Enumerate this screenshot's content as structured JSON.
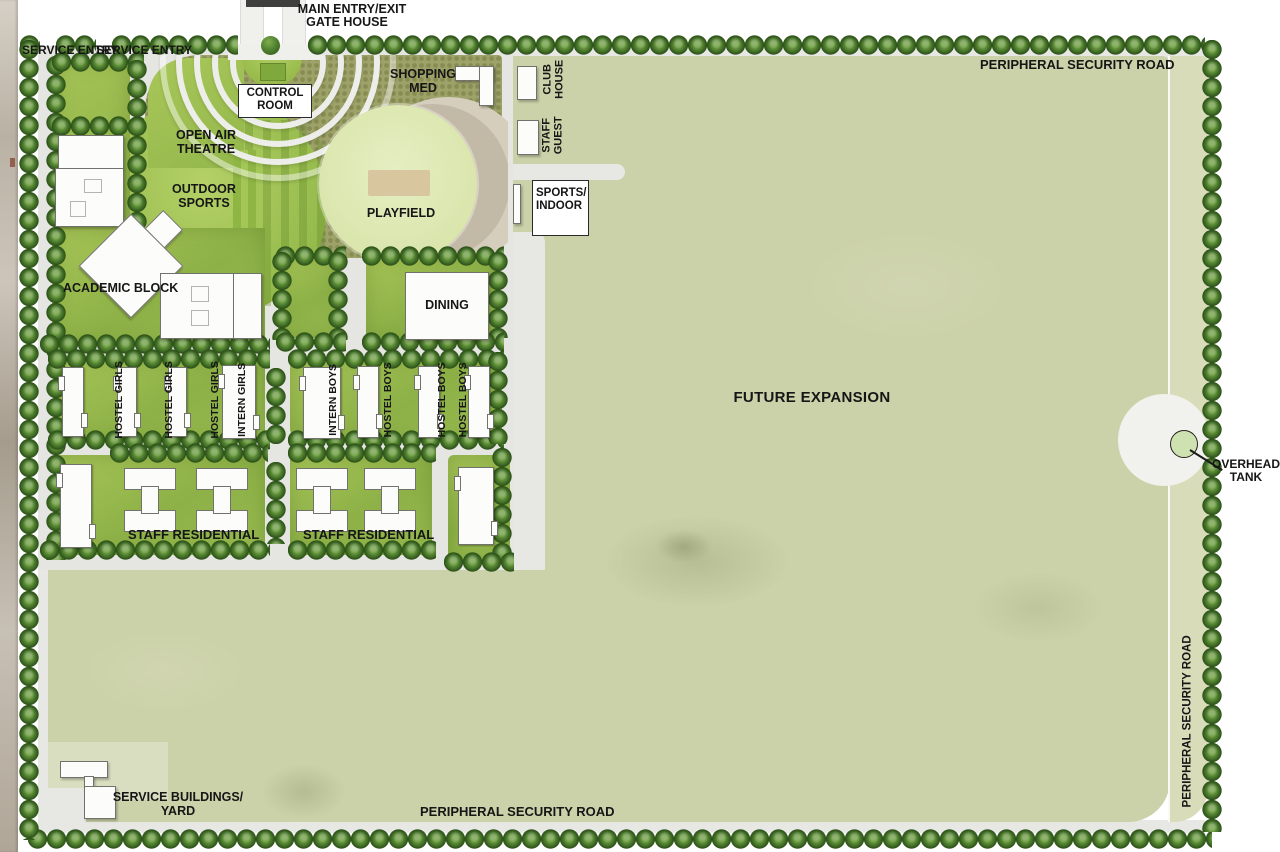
{
  "labels": {
    "main_entry_line1": "MAIN ENTRY/EXIT",
    "main_entry_line2": "GATE HOUSE",
    "service_entry_a": "SERVICE ENTRY",
    "service_entry_b": "SERVICE ENTRY",
    "road_top": "PERIPHERAL SECURITY ROAD",
    "road_right": "PERIPHERAL SECURITY ROAD",
    "road_bottom": "PERIPHERAL SECURITY ROAD",
    "shopping": "SHOPPING MED",
    "control_room": "CONTROL ROOM",
    "open_air_theatre": "OPEN AIR THEATRE",
    "outdoor_sports": "OUTDOOR SPORTS",
    "playfield": "PLAYFIELD",
    "club_house_line1": "CLUB",
    "club_house_line2": "HOUSE",
    "staff_guest_line1": "STAFF",
    "staff_guest_line2": "GUEST",
    "sports_indoor_line1": "SPORTS/",
    "sports_indoor_line2": "INDOOR",
    "academic_block": "ACADEMIC BLOCK",
    "dining": "DINING",
    "hostel_girls": [
      "HOSTEL GIRLS",
      "HOSTEL GIRLS",
      "HOSTEL GIRLS",
      "INTERN GIRLS"
    ],
    "hostel_boys": [
      "INTERN BOYS",
      "HOSTEL BOYS",
      "HOSTEL BOYS",
      "HOSTEL BOYS"
    ],
    "staff_residential_left": "STAFF RESIDENTIAL",
    "staff_residential_right": "STAFF RESIDENTIAL",
    "future_expansion": "FUTURE EXPANSION",
    "overhead_tank": "OVERHEAD TANK",
    "service_yard_line1": "SERVICE BUILDINGS/",
    "service_yard_line2": "YARD"
  },
  "colors": {
    "field_sage": "#cbd1a8",
    "right_road_sage": "#d8dcb8",
    "campus_ground": "#e5e5e2",
    "bright_green": "#a6c457",
    "block_green": "#8fb04c",
    "plaza_khaki": "#9da269",
    "playfield_pale": "#dfe8b6",
    "playfield_stage_tan": "#d8c69e",
    "crescent_light": "#d6cebd",
    "crescent_dark": "#c3b9a7",
    "tree_dark": "#2c5117",
    "tree_mid": "#45722a",
    "tree_light": "#7fae4c",
    "building_white": "#fcfcfa",
    "gate_house_dark": "#3f3f3d"
  }
}
